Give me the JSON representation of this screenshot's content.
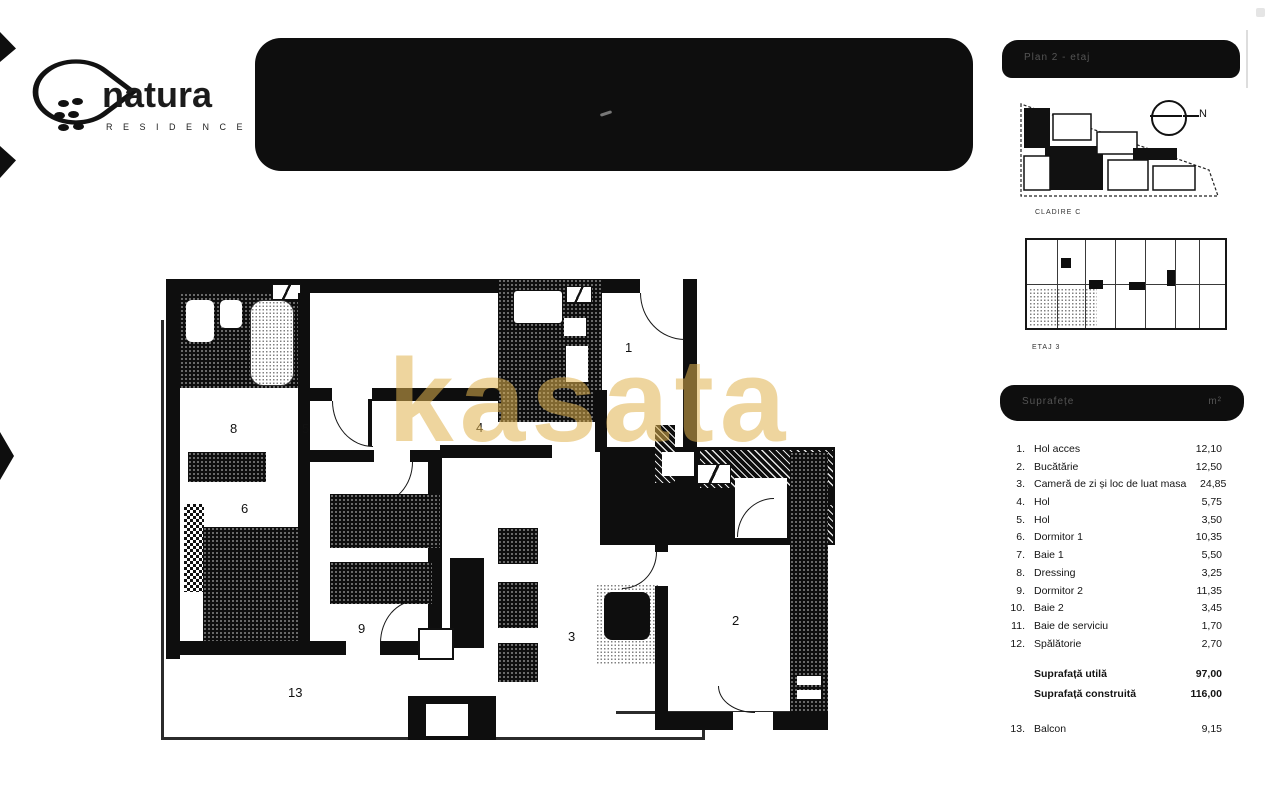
{
  "logo": {
    "name": "natura",
    "subtitle": "R E S I D E N C E"
  },
  "watermark": {
    "text": "kasata",
    "color": "#e0b24e"
  },
  "panels": {
    "plan_header": "Plan 2 - etaj",
    "site_plan_label": "CLADIRE C",
    "floor_plan_label": "ETAJ 3",
    "compass_label": "N",
    "table_header": {
      "left": "Suprafețe",
      "right": "m²"
    }
  },
  "rooms": [
    {
      "num": "1.",
      "label": "Hol acces",
      "area": "12,10"
    },
    {
      "num": "2.",
      "label": "Bucătărie",
      "area": "12,50"
    },
    {
      "num": "3.",
      "label": "Cameră de zi și loc de luat masa",
      "area": "24,85"
    },
    {
      "num": "4.",
      "label": "Hol",
      "area": "5,75"
    },
    {
      "num": "5.",
      "label": "Hol",
      "area": "3,50"
    },
    {
      "num": "6.",
      "label": "Dormitor 1",
      "area": "10,35"
    },
    {
      "num": "7.",
      "label": "Baie 1",
      "area": "5,50"
    },
    {
      "num": "8.",
      "label": "Dressing",
      "area": "3,25"
    },
    {
      "num": "9.",
      "label": "Dormitor 2",
      "area": "11,35"
    },
    {
      "num": "10.",
      "label": "Baie 2",
      "area": "3,45"
    },
    {
      "num": "11.",
      "label": "Baie de serviciu",
      "area": "1,70"
    },
    {
      "num": "12.",
      "label": "Spălătorie",
      "area": "2,70"
    }
  ],
  "totals": [
    {
      "label": "Suprafață utilă",
      "value": "97,00"
    },
    {
      "label": "Suprafață construită",
      "value": "116,00"
    }
  ],
  "balcony": {
    "num": "13.",
    "label": "Balcon",
    "area": "9,15"
  },
  "plan_labels": {
    "hall": "1",
    "kitchen": "2",
    "living": "3",
    "hol4": "4",
    "hol5": "5",
    "dorm1": "6",
    "dressing": "8",
    "dorm2": "9",
    "balcony": "13"
  }
}
